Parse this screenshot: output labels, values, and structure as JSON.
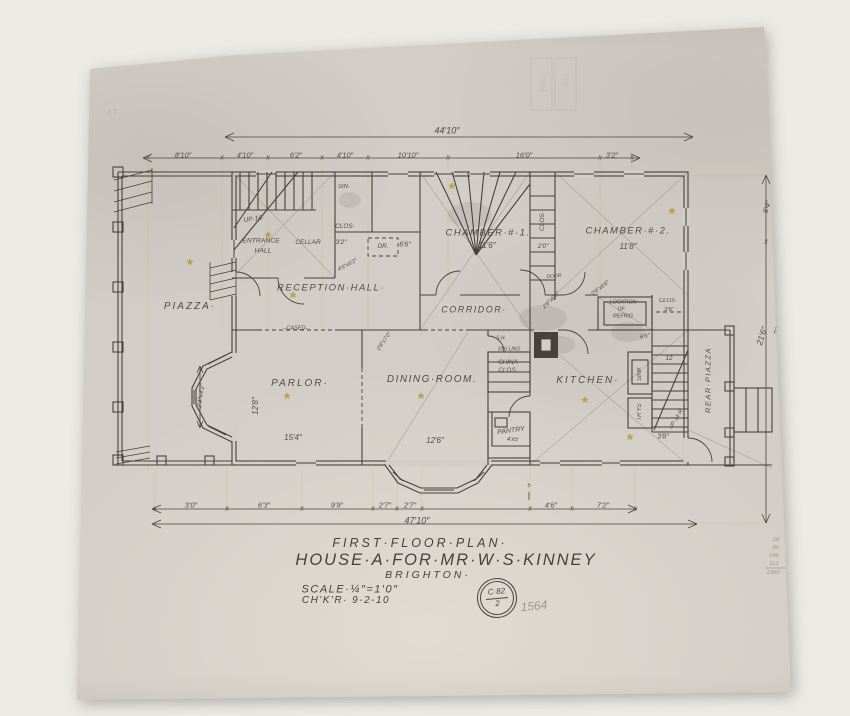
{
  "title_block": {
    "plan_title": "FIRST·FLOOR·PLAN·",
    "project": "HOUSE·A·FOR·MR·W·S·KINNEY",
    "location": "BRIGHTON·",
    "scale": "SCALE·¼″=1′0″",
    "checked": "CH'K'R·  9-2-10"
  },
  "stamp": {
    "line1": "C·82",
    "line2": "2"
  },
  "colors": {
    "ink": "#46413b",
    "pencil": "#8f887c",
    "gold_star": "#b8952a",
    "paper": "#d2cec7"
  },
  "labels": [
    {
      "n": "room-label-piazza",
      "t": "PIAZZA·",
      "x": 190,
      "y": 307,
      "s": 10,
      "ls": 2
    },
    {
      "n": "room-label-reception-hall",
      "t": "RECEPTION·HALL·",
      "x": 331,
      "y": 288,
      "s": 9.5,
      "ls": 1.5
    },
    {
      "n": "room-label-entrance",
      "t": "ENTRANCE",
      "x": 261,
      "y": 242,
      "s": 6.8
    },
    {
      "n": "room-label-entrance-hall",
      "t": "HALL",
      "x": 263,
      "y": 252,
      "s": 6.8
    },
    {
      "n": "label-cellar",
      "t": "CELLAR",
      "x": 308,
      "y": 243,
      "s": 6.5
    },
    {
      "n": "dim-3-2-hall",
      "t": "3′2″",
      "x": 341,
      "y": 243,
      "s": 6.5
    },
    {
      "n": "label-clos-hall",
      "t": "CLOS·",
      "x": 345,
      "y": 227,
      "s": 6.5
    },
    {
      "n": "label-dr",
      "t": "DR.",
      "x": 383,
      "y": 247,
      "s": 6.2
    },
    {
      "n": "dim-6-6-hall",
      "t": "6′6″",
      "x": 405,
      "y": 245,
      "s": 7
    },
    {
      "n": "label-up-16",
      "t": "UP·16·",
      "x": 254,
      "y": 220,
      "s": 6.5,
      "r": -8
    },
    {
      "n": "label-sin",
      "t": "SIN·",
      "x": 344,
      "y": 187,
      "s": 6
    },
    {
      "n": "room-label-chamber-1",
      "t": "CHAMBER·#·1.",
      "x": 488,
      "y": 233,
      "s": 9.5,
      "ls": 1.5
    },
    {
      "n": "dim-chamber-1",
      "t": "11′6″",
      "x": 487,
      "y": 246,
      "s": 8
    },
    {
      "n": "room-label-chamber-2",
      "t": "CHAMBER·#·2.",
      "x": 628,
      "y": 231,
      "s": 9.5,
      "ls": 1.5
    },
    {
      "n": "dim-chamber-2",
      "t": "11′8″",
      "x": 628,
      "y": 247,
      "s": 8
    },
    {
      "n": "label-clos-mid",
      "t": "CLOS·",
      "x": 543,
      "y": 221,
      "s": 6.5,
      "r": -90
    },
    {
      "n": "dim-2-0",
      "t": "2′0″",
      "x": 543,
      "y": 247,
      "s": 6.5
    },
    {
      "n": "label-door",
      "t": "DOOR",
      "x": 554,
      "y": 277,
      "s": 5,
      "r": -5
    },
    {
      "n": "room-label-corridor",
      "t": "CORRIDOR·",
      "x": 474,
      "y": 310,
      "s": 9,
      "ls": 1.5
    },
    {
      "n": "label-location-1",
      "t": "LOCATION",
      "x": 623,
      "y": 303,
      "s": 5.3
    },
    {
      "n": "label-location-2",
      "t": "OF",
      "x": 621,
      "y": 310,
      "s": 5.3
    },
    {
      "n": "label-location-3",
      "t": "REFRIG",
      "x": 623,
      "y": 317,
      "s": 5.3
    },
    {
      "n": "label-clos-2",
      "t": "CLOS·",
      "x": 668,
      "y": 301,
      "s": 6
    },
    {
      "n": "dim-3-6",
      "t": "3′6″",
      "x": 669,
      "y": 310,
      "s": 6
    },
    {
      "n": "dim-6-6-b",
      "t": "6′6″",
      "x": 645,
      "y": 337,
      "s": 6,
      "r": -12
    },
    {
      "n": "room-label-parlor",
      "t": "PARLOR·",
      "x": 300,
      "y": 384,
      "s": 10,
      "ls": 2
    },
    {
      "n": "dim-parlor-w",
      "t": "15′4″",
      "x": 293,
      "y": 438,
      "s": 8
    },
    {
      "n": "dim-parlor-h",
      "t": "12′8″",
      "x": 256,
      "y": 406,
      "s": 8,
      "r": -90
    },
    {
      "n": "room-label-dining",
      "t": "DINING·ROOM.",
      "x": 432,
      "y": 380,
      "s": 10,
      "ls": 1.5
    },
    {
      "n": "dim-dining",
      "t": "12′6″",
      "x": 435,
      "y": 441,
      "s": 8
    },
    {
      "n": "room-label-kitchen",
      "t": "KITCHEN·",
      "x": 588,
      "y": 381,
      "s": 10,
      "ls": 2
    },
    {
      "n": "label-china-1",
      "t": "·CHINA·",
      "x": 508,
      "y": 363,
      "s": 6.3
    },
    {
      "n": "label-china-2",
      "t": "CLOS·",
      "x": 508,
      "y": 371,
      "s": 6.3
    },
    {
      "n": "label-sh",
      "t": "S.H.",
      "x": 501,
      "y": 339,
      "s": 5
    },
    {
      "n": "label-lino",
      "t": "3′06·LINO",
      "x": 509,
      "y": 350,
      "s": 5
    },
    {
      "n": "room-label-pantry",
      "t": "PANTRY",
      "x": 511,
      "y": 431,
      "s": 7,
      "r": -8
    },
    {
      "n": "dim-pantry",
      "t": "4′x5′",
      "x": 513,
      "y": 440,
      "s": 6
    },
    {
      "n": "label-sink",
      "t": "SINK",
      "x": 640,
      "y": 374,
      "s": 6,
      "r": -90
    },
    {
      "n": "label-trays",
      "t": "TR'YS",
      "x": 640,
      "y": 412,
      "s": 6,
      "r": -90
    },
    {
      "n": "room-label-rear-piazza",
      "t": "REAR·PIAZZA·",
      "x": 708,
      "y": 378,
      "s": 7.5,
      "r": -90,
      "ls": 1.5
    },
    {
      "n": "label-12-risers",
      "t": "12",
      "x": 669,
      "y": 359,
      "s": 6.5
    },
    {
      "n": "dim-3-8",
      "t": "3′8″",
      "x": 663,
      "y": 437,
      "s": 7
    },
    {
      "n": "label-up-14",
      "t": "UP·14·R",
      "x": 677,
      "y": 420,
      "s": 5.5,
      "r": -58
    },
    {
      "n": "label-cased",
      "t": "–CASED–",
      "x": 296,
      "y": 329,
      "s": 5.5
    },
    {
      "n": "door-size-1",
      "t": "2′6″x6′6″",
      "x": 552,
      "y": 301,
      "s": 5.5,
      "r": -45
    },
    {
      "n": "door-size-2",
      "t": "2′8″x6′8″",
      "x": 601,
      "y": 289,
      "s": 5.5,
      "r": -38
    },
    {
      "n": "door-size-3",
      "t": "2′8″x7′0″",
      "x": 385,
      "y": 342,
      "s": 5.5,
      "r": -55
    },
    {
      "n": "door-size-4",
      "t": "4′6″x6′2″",
      "x": 348,
      "y": 266,
      "s": 5.5,
      "r": -28
    },
    {
      "n": "dim-bay",
      "t": "2′4″x4′2″",
      "x": 202,
      "y": 396,
      "s": 6.5,
      "r": -82
    },
    {
      "n": "dim-top-1",
      "t": "8′10″",
      "x": 183,
      "y": 155,
      "s": 7.5
    },
    {
      "n": "dim-top-2",
      "t": "4′10″",
      "x": 245,
      "y": 155,
      "s": 7.5
    },
    {
      "n": "dim-top-3",
      "t": "6′2″",
      "x": 296,
      "y": 155,
      "s": 7.5
    },
    {
      "n": "dim-top-4",
      "t": "4′10″",
      "x": 345,
      "y": 155,
      "s": 7.5
    },
    {
      "n": "dim-top-5",
      "t": "10′10″",
      "x": 408,
      "y": 155,
      "s": 7.5
    },
    {
      "n": "dim-top-6",
      "t": "16′0″",
      "x": 524,
      "y": 155,
      "s": 7.5
    },
    {
      "n": "dim-top-7",
      "t": "3′2″",
      "x": 612,
      "y": 155,
      "s": 7.5
    },
    {
      "n": "dim-top-overall",
      "t": "44′10″",
      "x": 447,
      "y": 131,
      "s": 9
    },
    {
      "n": "dim-bot-1",
      "t": "3′0″",
      "x": 191,
      "y": 505,
      "s": 7.5
    },
    {
      "n": "dim-bot-2",
      "t": "6′3″",
      "x": 264,
      "y": 505,
      "s": 7.5
    },
    {
      "n": "dim-bot-3",
      "t": "9′9″",
      "x": 337,
      "y": 505,
      "s": 7.5
    },
    {
      "n": "dim-bot-4",
      "t": "2′7″",
      "x": 385,
      "y": 505,
      "s": 7.5
    },
    {
      "n": "dim-bot-5",
      "t": "2′7″",
      "x": 410,
      "y": 505,
      "s": 7.5
    },
    {
      "n": "dim-bot-6",
      "t": "4′6″",
      "x": 551,
      "y": 505,
      "s": 7.5
    },
    {
      "n": "dim-bot-7",
      "t": "7′2″",
      "x": 603,
      "y": 505,
      "s": 7.5
    },
    {
      "n": "dim-bot-overall",
      "t": "47′10″",
      "x": 417,
      "y": 521,
      "s": 9
    },
    {
      "n": "dim-5",
      "t": "5",
      "x": 529,
      "y": 486,
      "s": 6
    },
    {
      "n": "dim-right-21-6",
      "t": "21′6″",
      "x": 762,
      "y": 336,
      "s": 8.5,
      "r": -72
    },
    {
      "n": "dim-right-27-10",
      "t": "27′10″",
      "x": 780,
      "y": 324,
      "s": 8.5,
      "r": -72
    },
    {
      "n": "dim-right-6-4",
      "t": "6′4″",
      "x": 767,
      "y": 207,
      "s": 7.5,
      "r": -72
    },
    {
      "n": "pencil-1564",
      "t": "1564",
      "x": 534,
      "y": 606,
      "s": 12,
      "r": -6,
      "k": "pencil"
    },
    {
      "n": "pencil-col-1",
      "t": "28",
      "x": 776,
      "y": 540,
      "s": 6,
      "k": "pencil"
    },
    {
      "n": "pencil-col-2",
      "t": "95",
      "x": 776,
      "y": 548,
      "s": 6,
      "k": "pencil"
    },
    {
      "n": "pencil-col-3",
      "t": "145",
      "x": 774,
      "y": 556,
      "s": 6,
      "k": "pencil"
    },
    {
      "n": "pencil-col-4",
      "t": "112",
      "x": 774,
      "y": 564,
      "s": 6,
      "k": "pencil"
    },
    {
      "n": "pencil-col-5",
      "t": "1360",
      "x": 773,
      "y": 573,
      "s": 6,
      "k": "pencil"
    },
    {
      "n": "pencil-top-left",
      "t": "3 2",
      "x": 112,
      "y": 113,
      "s": 7,
      "r": -12,
      "k": "faint"
    },
    {
      "n": "pencil-top-right",
      "t": "2 8 4",
      "x": 786,
      "y": 96,
      "s": 7,
      "r": -18,
      "k": "faint"
    },
    {
      "n": "stamp-faint-1",
      "t": "1564",
      "x": 542,
      "y": 84,
      "s": 7,
      "r": 90,
      "k": "ghost"
    },
    {
      "n": "stamp-faint-2",
      "t": "85",
      "x": 565,
      "y": 82,
      "s": 7,
      "r": 90,
      "k": "ghost"
    }
  ],
  "ticks": [
    {
      "y": 157,
      "xs": [
        148,
        222,
        268,
        322,
        368,
        448,
        600,
        632
      ]
    },
    {
      "y": 508,
      "xs": [
        155,
        227,
        302,
        373,
        397,
        422,
        530,
        572,
        635
      ]
    },
    {
      "y": 241,
      "xs": [
        766
      ]
    }
  ],
  "stars": [
    [
      268,
      236
    ],
    [
      452,
      187
    ],
    [
      672,
      212
    ],
    [
      293,
      296
    ],
    [
      190,
      263
    ],
    [
      287,
      397
    ],
    [
      421,
      397
    ],
    [
      585,
      401
    ],
    [
      630,
      438
    ]
  ],
  "star_glyph": "*",
  "tick_glyph": "x"
}
